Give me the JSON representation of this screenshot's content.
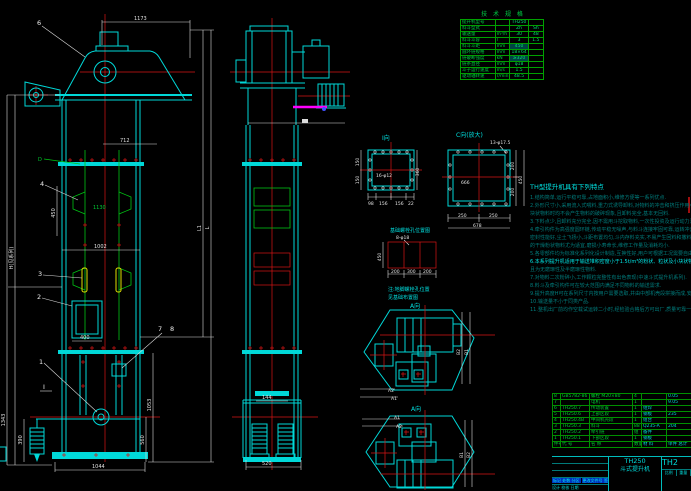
{
  "colors": {
    "cyan": "#00d8d8",
    "red": "#d81414",
    "green": "#00c414",
    "white": "#dcdcdc",
    "yellow": "#e0e000",
    "magenta": "#ff00ff",
    "dim_teal": "#007d7d",
    "table_green": "#00a000",
    "blue_highlight": "#0030c0"
  },
  "spec_table": {
    "title": "技 术 规 格",
    "rows": [
      {
        "label": "提升机型号",
        "unit": "",
        "v1": "TH250",
        "v2": ""
      },
      {
        "label": "料斗型式",
        "unit": "",
        "v1": "Zh",
        "v2": "Sh"
      },
      {
        "label": "输送量",
        "unit": "m³/h",
        "v1": "30",
        "v2": "48"
      },
      {
        "label": "料斗斗容",
        "unit": "l",
        "v1": "3",
        "v2": "1.5"
      },
      {
        "label": "料斗斗距",
        "unit": "mm",
        "v1": "450",
        "v2": ""
      },
      {
        "label": "圆环链规格",
        "unit": "mm",
        "v1": "18×64",
        "v2": ""
      },
      {
        "label": "链破断强度",
        "unit": "kN",
        "v1": "≥320",
        "v2": ""
      },
      {
        "label": "链条直径",
        "unit": "mm",
        "v1": "φ18",
        "v2": ""
      },
      {
        "label": "斗子运行速度",
        "unit": "m/s",
        "v1": "1.5",
        "v2": ""
      },
      {
        "label": "驱动轴转速",
        "unit": "r/min",
        "v1": "48.5",
        "v2": ""
      }
    ]
  },
  "features": {
    "title": "TH型提升机具有下列特点",
    "lines_a": [
      "1.结构简单,运行平稳可靠,占地面积小,维修方便等一系列优点.",
      "2.外形尺寸小,采用流入式喂料,重力式诱导卸料,对物料的冲击和挤压作用小,故提升粉状及一般",
      "  块状物料时均不会产生物料的破碎现象,且卸料完全,基本无回料.",
      "3.下料点少,且卸料充分完全,因不需用斗挖取物料,一次性投资及运行动力消耗均较低,适用面广.",
      "4.牵引构件为高强度圆环链,传动平稳无噪声,与料斗连接牢固可靠,运转冲击小,工况适应能力强,",
      "  密封性能好,尘土飞扬小,斗距布置均匀,斗内存料充实,不易产生回料和撒料现象,对含尘量较大",
      "  的干燥粉状物料尤为适宜,磨损小寿命长,维修工作量及消耗均小.",
      "5.各零部件均为标准化系列化设计制造,互换性好,用户可根据工况需要自由选配组合,经济适用."
    ],
    "bright_line": "6.本系列提升机适用于输送堆积密度小于1.5t/m³的粉状、粒状及小块状物料,",
    "bright_tail": "物料温度不超过250℃",
    "lines_b": [
      "  且为无磨琢性及半磨琢性物料.",
      "7.对物料二次粉碎小,工作颗粒完整性有出色表现(中速斗式提升机系列).",
      "8.料斗及牵引构件可在较大范围内满足不同物料的输送需求.",
      "9.提升高度H可在系列尺寸内按用户需要选取,并由中部机壳段拼接而成,安装灵活方便.",
      "10.输送量不小于同类产品.",
      "11.整机出厂前均作空载试运转二小时,经检验合格后方可出厂,质量可靠一流."
    ]
  },
  "bom": {
    "header": {
      "no": "件号",
      "code": "代 号",
      "name": "名 称",
      "qty": "数量",
      "mat": "材 料",
      "wt": "单件 总计"
    },
    "rows": [
      {
        "no": "8",
        "code": "GB5782-86",
        "name": "螺栓 M20×80",
        "qty": "4",
        "mat": "",
        "wt": "0.05"
      },
      {
        "no": "7",
        "code": "",
        "name": "电机",
        "qty": "1",
        "mat": "",
        "wt": "9.05"
      },
      {
        "no": "6",
        "code": "TH250.7",
        "name": "传动装置",
        "qty": "1",
        "mat": "组焊",
        "wt": ""
      },
      {
        "no": "5",
        "code": "TH250.6",
        "name": "上部区段",
        "qty": "1",
        "mat": "钢板",
        "wt": "235"
      },
      {
        "no": "4",
        "code": "TH250.4B",
        "name": "中间机壳段",
        "qty": "1",
        "mat": "组合",
        "wt": ""
      },
      {
        "no": "3",
        "code": "TH250.3",
        "name": "料斗",
        "qty": "88",
        "mat": "Q235-A",
        "wt": "204"
      },
      {
        "no": "2",
        "code": "TH250.2",
        "name": "牵引链",
        "qty": "组",
        "mat": "备件",
        "wt": ""
      },
      {
        "no": "1",
        "code": "TH250.1",
        "name": "下部区段",
        "qty": "1",
        "mat": "钢板",
        "wt": ""
      }
    ]
  },
  "title_block": {
    "model": "TH250",
    "product": "斗式提升机",
    "drawing_no": "TH2",
    "rev_left": "标记 处数 分区",
    "rev_right": "更改文件号 签名",
    "sign_row": "设计  校核  日期",
    "scale_label": "比例",
    "weight_label": "重量"
  },
  "view_labels": {
    "i_view": "I向",
    "c_view": "C向(放大)",
    "a_top": "A向",
    "a_bottom": "A向",
    "anchor_title": "基础螺栓孔位置图",
    "anchor_note1": "注:地脚螺栓孔位置",
    "anchor_note2": "见基础布置图"
  },
  "dims": {
    "d1173": "1173",
    "d712": "712",
    "d1130": "1130",
    "d450": "450",
    "d1002": "1002",
    "d400": "400",
    "d1044": "1044",
    "d1343": "1343",
    "d390": "390",
    "dH": "H(见系列)",
    "d1053": "1053",
    "d560": "560",
    "dL": "L",
    "dL1": "L1",
    "d520": "520",
    "d144": "144",
    "aa1": "A1",
    "aa2": "A2",
    "ab1": "B1",
    "ab2": "B2",
    "iv360": "360",
    "iv150a": "150",
    "iv150b": "150",
    "iv98": "98",
    "iv156a": "156",
    "iv156b": "156",
    "iv22": "22",
    "ivnote": "16-φ12",
    "cv200a": "200",
    "cv200b": "200",
    "cv450": "450",
    "cv666": "666",
    "cv250a": "250",
    "cv250b": "250",
    "cv678": "678",
    "cvnote": "13-φ17.5",
    "an450": "450",
    "an200a": "200",
    "an300": "300",
    "an200b": "200",
    "annote": "8-φ18"
  },
  "balloons": {
    "n1": "1",
    "n2": "2",
    "n3": "3",
    "n4": "4",
    "n6": "6",
    "n7": "7",
    "n8": "8",
    "D": "D",
    "I": "I"
  }
}
